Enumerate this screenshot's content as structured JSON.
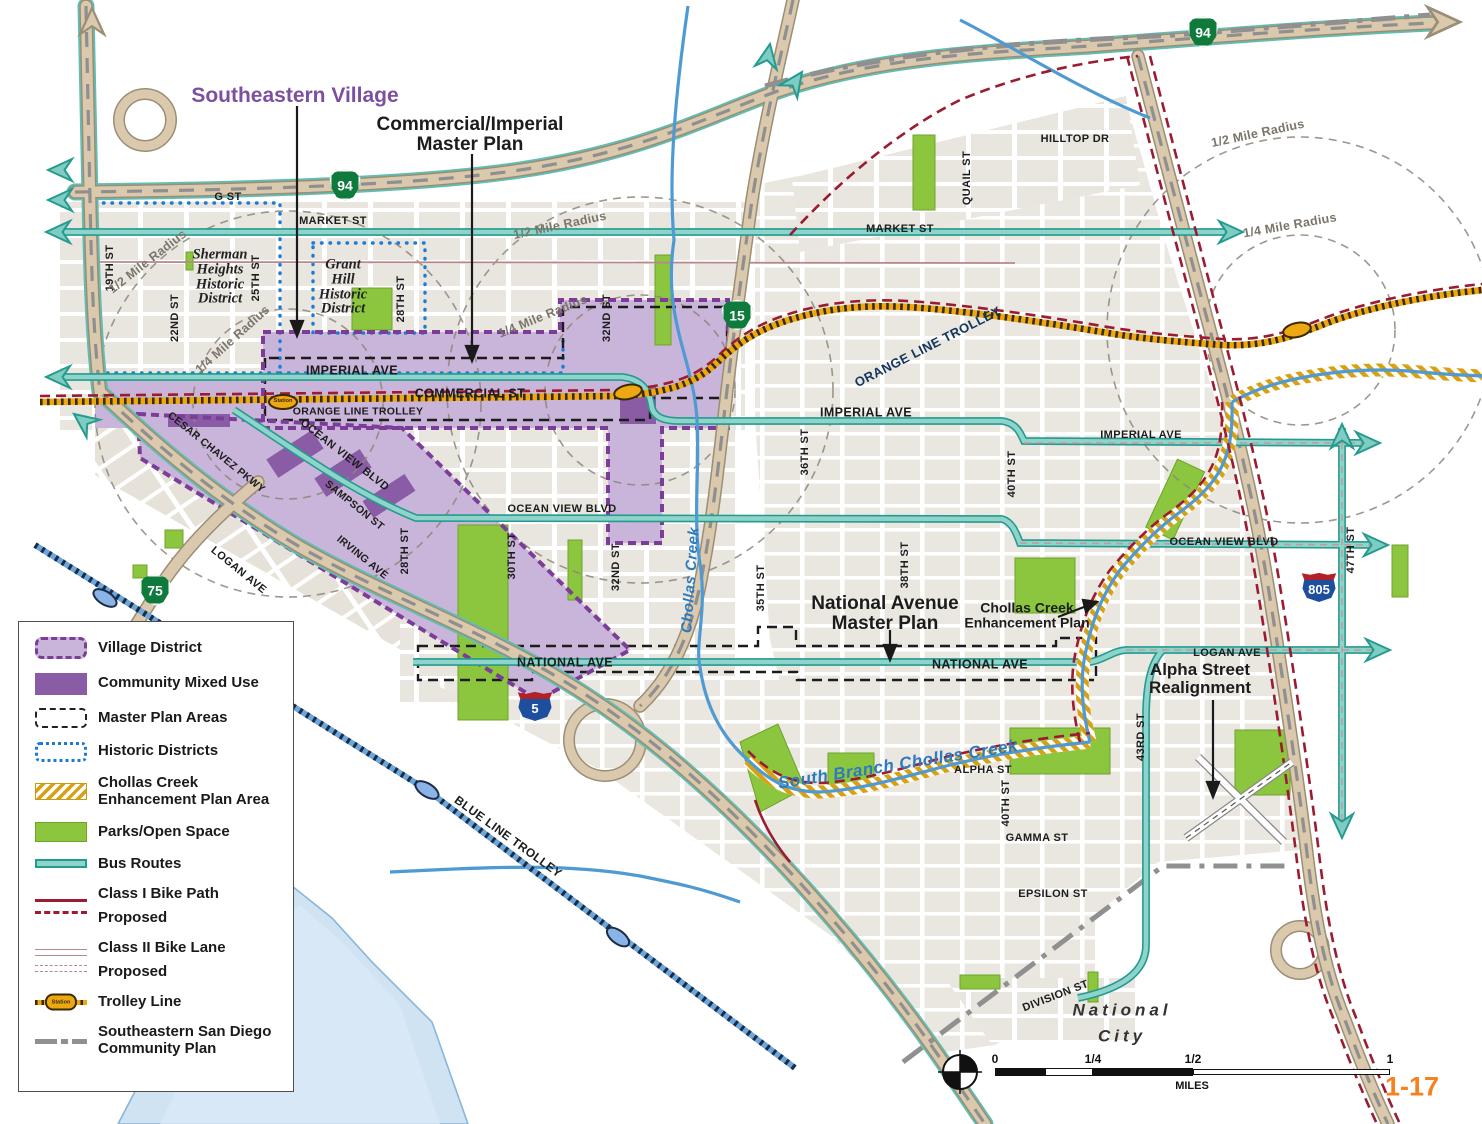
{
  "page_number": "1-17",
  "city_label": "National\nCity",
  "callouts": {
    "southeastern_village": "Southeastern Village",
    "commercial_imperial": "Commercial/Imperial\nMaster Plan",
    "national_avenue": "National Avenue\nMaster Plan",
    "chollas_enhancement": "Chollas Creek\nEnhancement Plan",
    "alpha_street": "Alpha Street\nRealignment"
  },
  "legend": {
    "items": [
      {
        "label": "Village District"
      },
      {
        "label": "Community Mixed Use"
      },
      {
        "label": "Master Plan Areas"
      },
      {
        "label": "Historic Districts"
      },
      {
        "label": "Chollas Creek\nEnhancement Plan Area"
      },
      {
        "label": "Parks/Open Space"
      },
      {
        "label": "Bus Routes"
      },
      {
        "label": "Class I Bike Path"
      },
      {
        "label": "Class II Bike Lane"
      },
      {
        "label": "Trolley Line"
      },
      {
        "label": "Southeastern San Diego\nCommunity Plan"
      }
    ],
    "proposed_label": "Proposed"
  },
  "streets": {
    "g_st": "G  ST",
    "market": "MARKET  ST",
    "hilltop": "HILLTOP  DR",
    "quail": "QUAIL  ST",
    "st19": "19TH  ST",
    "st22": "22ND ST",
    "st25": "25TH ST",
    "st28": "28TH  ST",
    "st30": "30TH  ST",
    "st32": "32ND  ST",
    "st35": "35TH  ST",
    "st36": "36TH  ST",
    "st38": "38TH  ST",
    "st40": "40TH  ST",
    "st43": "43RD  ST",
    "st47": "47TH  ST",
    "imperial": "IMPERIAL  AVE",
    "commercial": "COMMERCIAL ST",
    "ocean_view": "OCEAN VIEW  BLVD",
    "national": "NATIONAL  AVE",
    "logan": "LOGAN  AVE",
    "cesar": "CESAR CHAVEZ PKWY",
    "sampson": "SAMPSON ST",
    "irving": "IRVING  AVE",
    "alpha": "ALPHA  ST",
    "gamma": "GAMMA  ST",
    "epsilon": "EPSILON  ST",
    "division": "DIVISION  ST"
  },
  "transit": {
    "orange_line": "ORANGE LINE TROLLEY",
    "blue_line": "BLUE LINE TROLLEY",
    "station": "Station"
  },
  "waterways": {
    "chollas": "Chollas  Creek",
    "south_branch": "South Branch Chollas Creek"
  },
  "radius_labels": {
    "half": "1/2 Mile Radius",
    "quarter": "1/4 Mile Radius"
  },
  "historic": {
    "sherman": "Sherman\nHeights\nHistoric\nDistrict",
    "grant": "Grant\nHill\nHistoric\nDistrict"
  },
  "shields": {
    "sr94": "94",
    "i15": "15",
    "sr75": "75",
    "i5": "5",
    "i805": "805"
  },
  "scalebar": {
    "zero": "0",
    "quarter": "1/4",
    "half": "1/2",
    "one": "1",
    "unit": "MILES"
  },
  "colors": {
    "village_fill": "#c9b4da",
    "community_mixed": "#8a5ca6",
    "village_border": "#7b3d97",
    "historic_border": "#1a7cd5",
    "parks": "#8cc63e",
    "bus": "#6fc7bd",
    "bike": "#9b1b30",
    "trolley": "#eca713",
    "creek": "#4f9ad2",
    "boundary": "#909090",
    "page_accent": "#f5821f"
  }
}
